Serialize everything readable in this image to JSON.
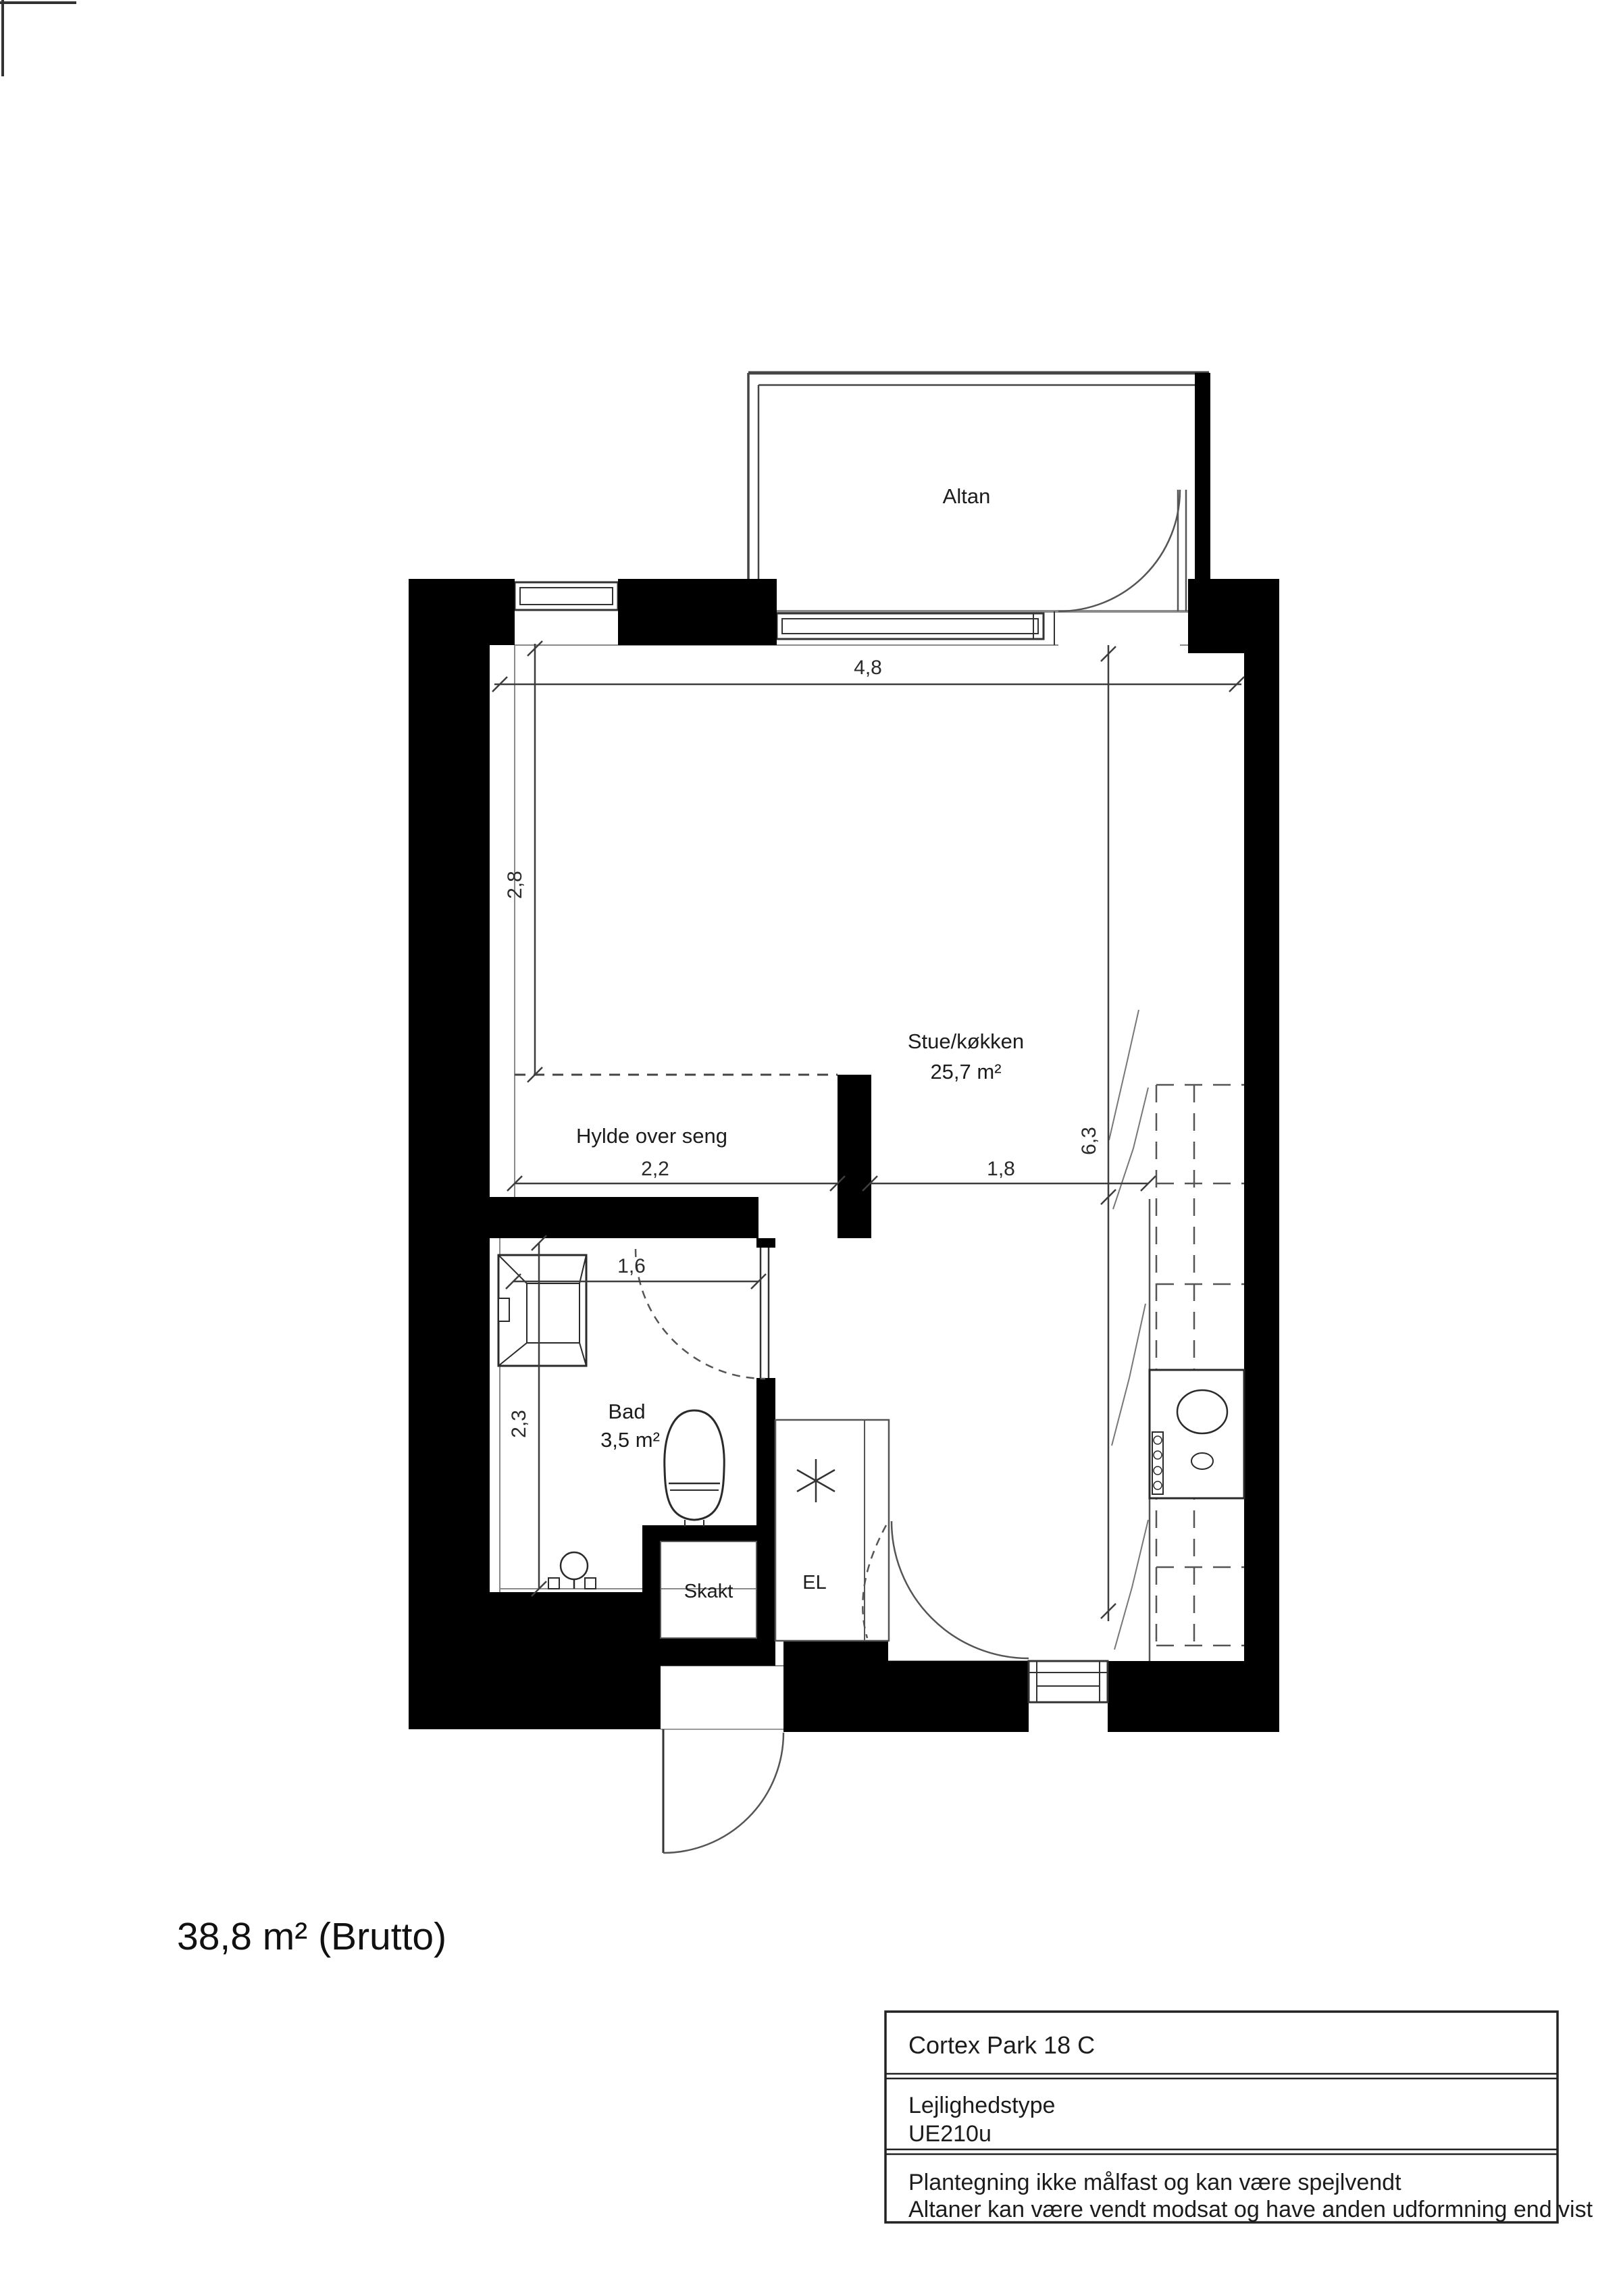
{
  "plan": {
    "rooms": {
      "balcony_label": "Altan",
      "living_label": "Stue/køkken",
      "living_area": "25,7 m²",
      "alcove_label": "Hylde over seng",
      "bath_label": "Bad",
      "bath_area": "3,5 m²",
      "shaft_label": "Skakt",
      "electrical_label": "EL"
    },
    "dimensions": {
      "top_width": "4,8",
      "alcove_height": "2,8",
      "interior_height": "6,3",
      "alcove_width": "2,2",
      "hall_width": "1,8",
      "bath_width": "1,6",
      "bath_height": "2,3"
    },
    "total_area": "38,8 m² (Brutto)"
  },
  "title_block": {
    "address": "Cortex Park 18 C",
    "type_label": "Lejlighedstype",
    "type_value": "UE210u",
    "note_line1": "Plantegning ikke målfast og kan være spejlvendt",
    "note_line2": "Altaner kan være vendt modsat og have anden udformning end vist"
  },
  "colors": {
    "wall": "#000000",
    "fixture_line": "#2a2a2a",
    "thin_line": "#555555",
    "lining": "#8a8a8a",
    "dim_line": "#3d3d3d"
  }
}
